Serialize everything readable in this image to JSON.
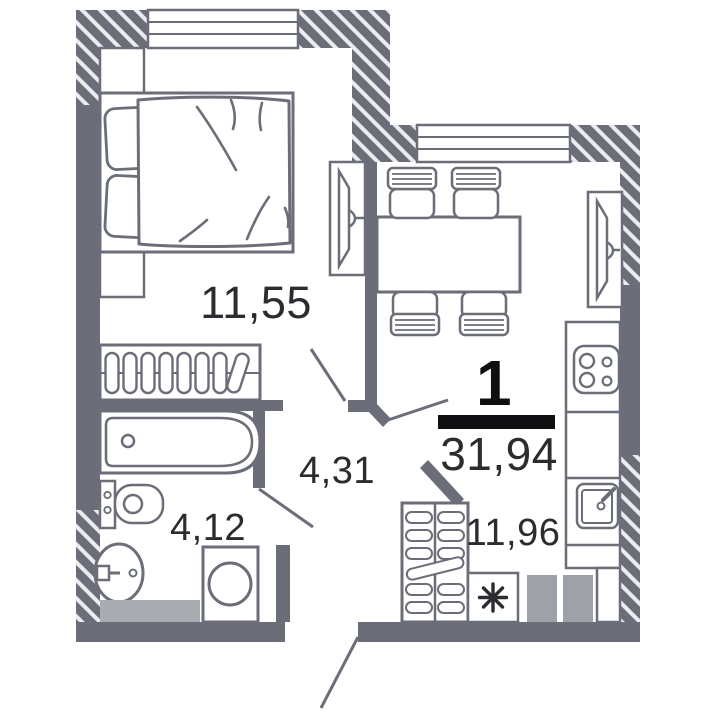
{
  "plan": {
    "apartment": {
      "rooms_count": "1",
      "total_area": "31,94"
    },
    "rooms": {
      "bedroom": {
        "area": "11,55"
      },
      "hallway": {
        "area": "4,31"
      },
      "bathroom": {
        "area": "4,12"
      },
      "kitchen": {
        "area": "11,96"
      }
    },
    "icons": {
      "washing_machine_place": "asterisk-icon"
    },
    "colors": {
      "wall": "#6b6e79",
      "hatch_line": "#eaecef",
      "text": "#2b2b30",
      "dark": "#0f0f12",
      "appliance_fill": "#9fa1a8",
      "cabinet_fill": "#aaacb2"
    }
  }
}
